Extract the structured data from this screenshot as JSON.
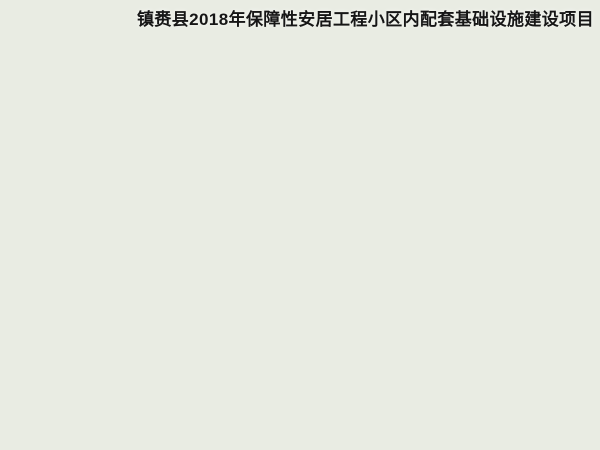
{
  "title": {
    "text": "镇赉县2018年保障性安居工程小区内配套基础设施建设项目"
  },
  "palette": {
    "title_color": "#161616",
    "mist": "#f6f6f2",
    "hill": "#87a872",
    "forest_tr": "#7ba368",
    "forest_bl": "#24421e",
    "ground_light": "#a5cd68",
    "ground_deep": "#7fb24a",
    "road_asphalt": "#3e4146",
    "road_minor": "#5c6066",
    "roof_red": "#d04a1a",
    "roof_ridge": "#ef8a46",
    "roof_tall": "#d9d2bd",
    "facade_cream": "#e9d7a0",
    "facade_window": "#8a6038",
    "facade_accent": "#c57a36",
    "end_wall_tall": "#c7a96e",
    "end_wall_mid": "#d9bf86",
    "strip_roof_gray": "#cdd2d6",
    "strip_side_dark": "#22252a",
    "blue_paving": "#3d5c80",
    "wall_red": "#8f3522",
    "water_shallow": "#5ec4da",
    "water_deep": "#0f5f8a",
    "sand": "#e6d8b2",
    "path_tan": "#dbd0ac",
    "pond_teal": "#2e6e72",
    "tree_bright": "#5f9c3b",
    "tree_dark": "#2f5c23",
    "bush_yellow": "#b8cf6d"
  },
  "scene": {
    "buildings": [
      [
        100,
        209,
        "t"
      ],
      [
        152,
        179,
        "t"
      ],
      [
        204,
        149,
        "t"
      ],
      [
        256,
        119,
        "t"
      ],
      [
        304,
        100,
        "t"
      ],
      [
        126,
        230,
        "t"
      ],
      [
        176,
        202,
        "t"
      ],
      [
        230,
        172,
        "t"
      ],
      [
        286,
        140,
        "m"
      ],
      [
        344,
        118,
        "m"
      ],
      [
        162,
        252,
        "t"
      ],
      [
        212,
        226,
        "t"
      ],
      [
        268,
        194,
        "m"
      ],
      [
        330,
        158,
        "m"
      ],
      [
        386,
        144,
        "m"
      ],
      [
        198,
        276,
        "t"
      ],
      [
        248,
        250,
        "t"
      ],
      [
        304,
        218,
        "m"
      ],
      [
        366,
        182,
        "m"
      ],
      [
        424,
        162,
        "m"
      ],
      [
        232,
        304,
        "s"
      ],
      [
        284,
        274,
        "s"
      ],
      [
        340,
        241,
        "m"
      ],
      [
        402,
        205,
        "m"
      ],
      [
        460,
        182,
        "m"
      ],
      [
        268,
        328,
        "s"
      ],
      [
        322,
        297,
        "m"
      ],
      [
        384,
        264,
        "m"
      ],
      [
        446,
        228,
        "m"
      ],
      [
        504,
        210,
        "m"
      ],
      [
        306,
        352,
        "s"
      ],
      [
        358,
        322,
        "m"
      ],
      [
        420,
        289,
        "m"
      ],
      [
        482,
        253,
        "m"
      ],
      [
        344,
        372,
        "m"
      ],
      [
        406,
        338,
        "m"
      ]
    ],
    "service_strip": {
      "x": 96,
      "y": 150,
      "len": 150,
      "w": 16,
      "h": 10
    },
    "gates": [
      [
        118,
        258,
        26
      ],
      [
        192,
        308,
        30
      ],
      [
        246,
        342,
        26
      ]
    ],
    "ponds": [
      [
        244,
        218,
        9,
        5
      ],
      [
        394,
        208,
        11,
        6
      ],
      [
        330,
        262,
        7,
        4
      ]
    ],
    "cars": [
      [
        12,
        -10,
        "#e9e9e9"
      ],
      [
        44,
        -18,
        "#b03226"
      ],
      [
        80,
        -10,
        "#2b4f8e"
      ],
      [
        118,
        -18,
        "#e9e9e9"
      ],
      [
        154,
        -10,
        "#26292e"
      ],
      [
        192,
        -18,
        "#d6dade"
      ],
      [
        226,
        -10,
        "#b03226"
      ],
      [
        28,
        10,
        "#dfe3e6"
      ],
      [
        66,
        18,
        "#26292e"
      ],
      [
        104,
        10,
        "#e9e9e9"
      ],
      [
        146,
        18,
        "#2b4f8e"
      ],
      [
        188,
        10,
        "#c9ced3"
      ],
      [
        226,
        18,
        "#e9e9e9"
      ]
    ]
  }
}
